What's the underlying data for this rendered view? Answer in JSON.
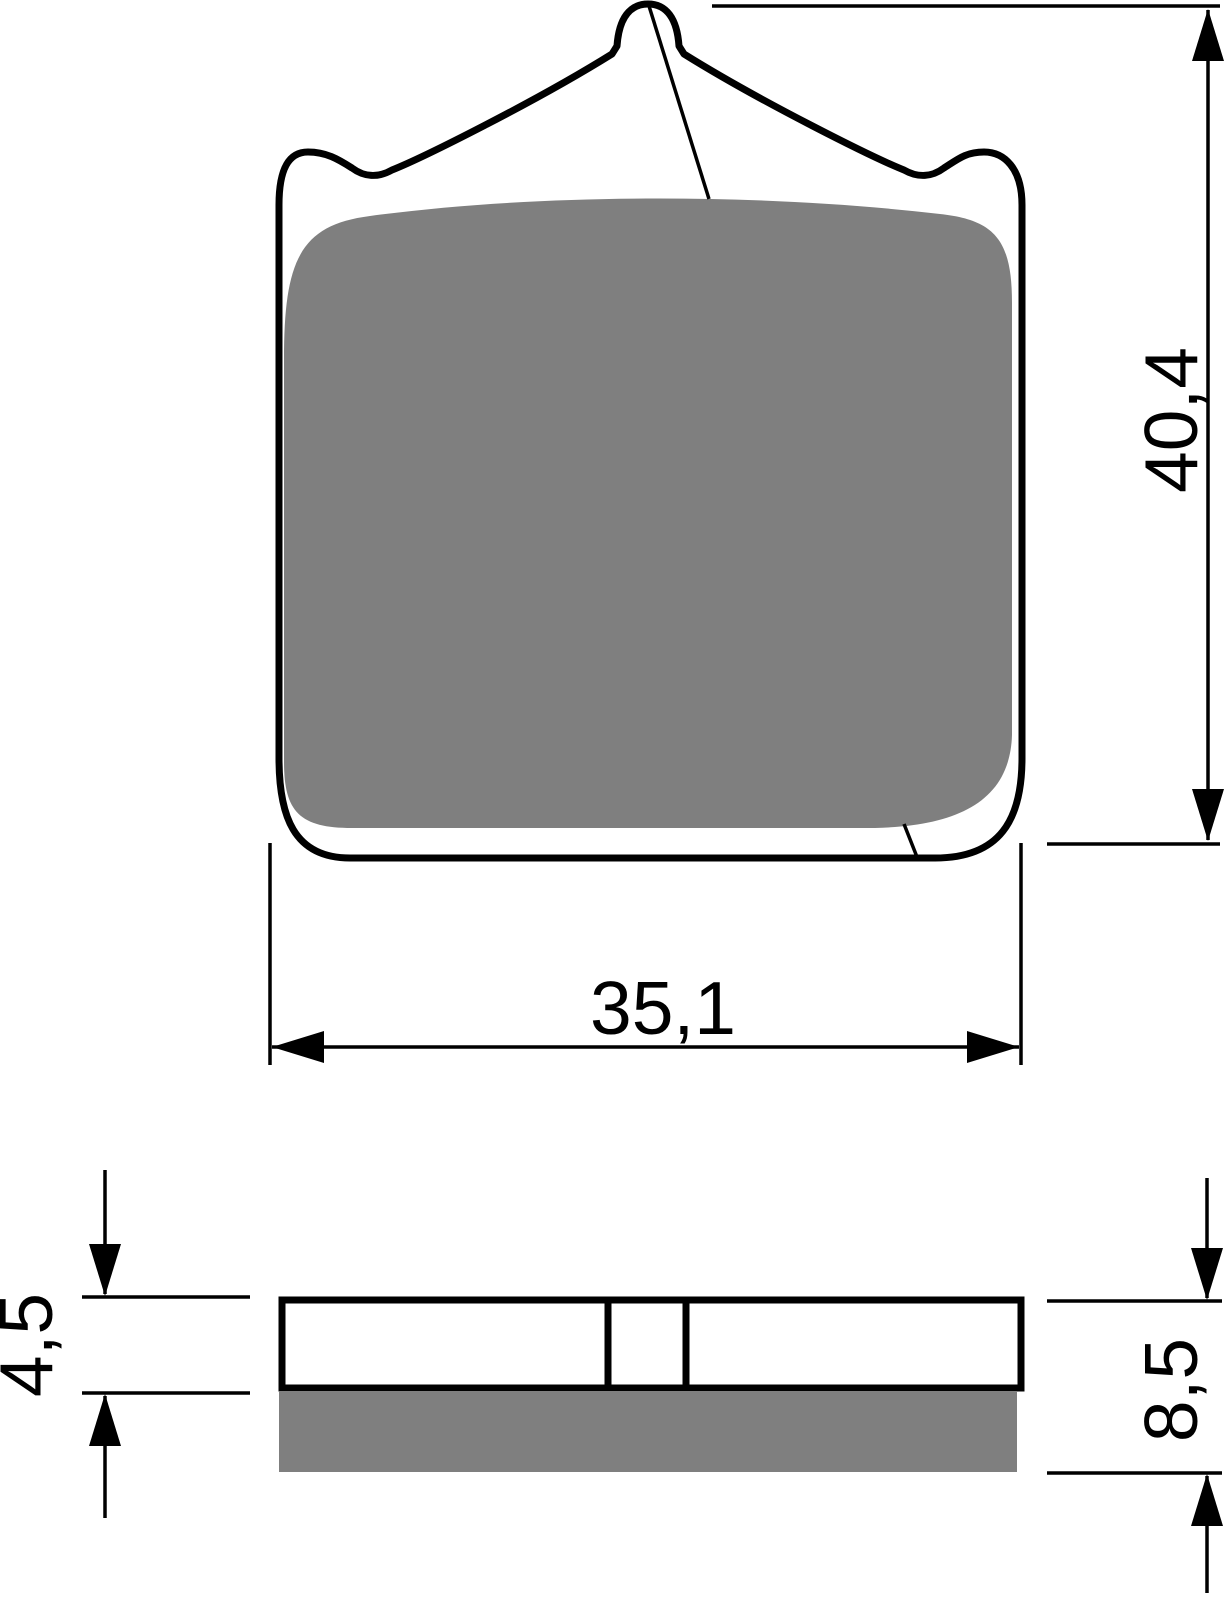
{
  "drawing": {
    "type": "technical-drawing",
    "subject": "brake-pad",
    "colors": {
      "outline": "#000000",
      "friction": "#7f7f7f",
      "backplate": "#ffffff",
      "background": "#ffffff"
    },
    "dimensions": {
      "pad_width": "35,1",
      "pad_height": "40,4",
      "plate_thickness": "4,5",
      "total_thickness": "8,5"
    }
  }
}
